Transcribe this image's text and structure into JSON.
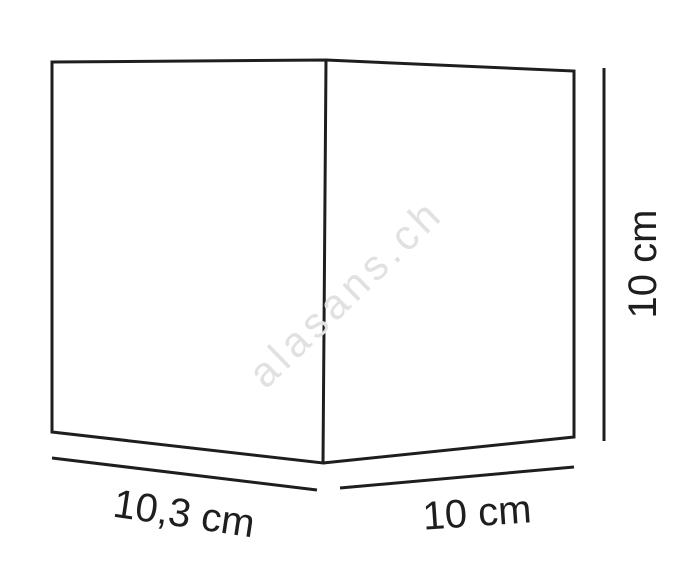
{
  "diagram": {
    "object": "cube-dimension-drawing",
    "watermark": "alasans.ch",
    "dimensions": {
      "width": {
        "label": "10,3 cm",
        "edge": "front-bottom"
      },
      "depth": {
        "label": "10 cm",
        "edge": "side-bottom"
      },
      "height": {
        "label": "10 cm",
        "edge": "right-vertical"
      }
    }
  },
  "colors": {
    "line": "#1e1e1e",
    "text": "#1e1e1e",
    "watermark": "#e1e1e1",
    "background": "#ffffff"
  }
}
